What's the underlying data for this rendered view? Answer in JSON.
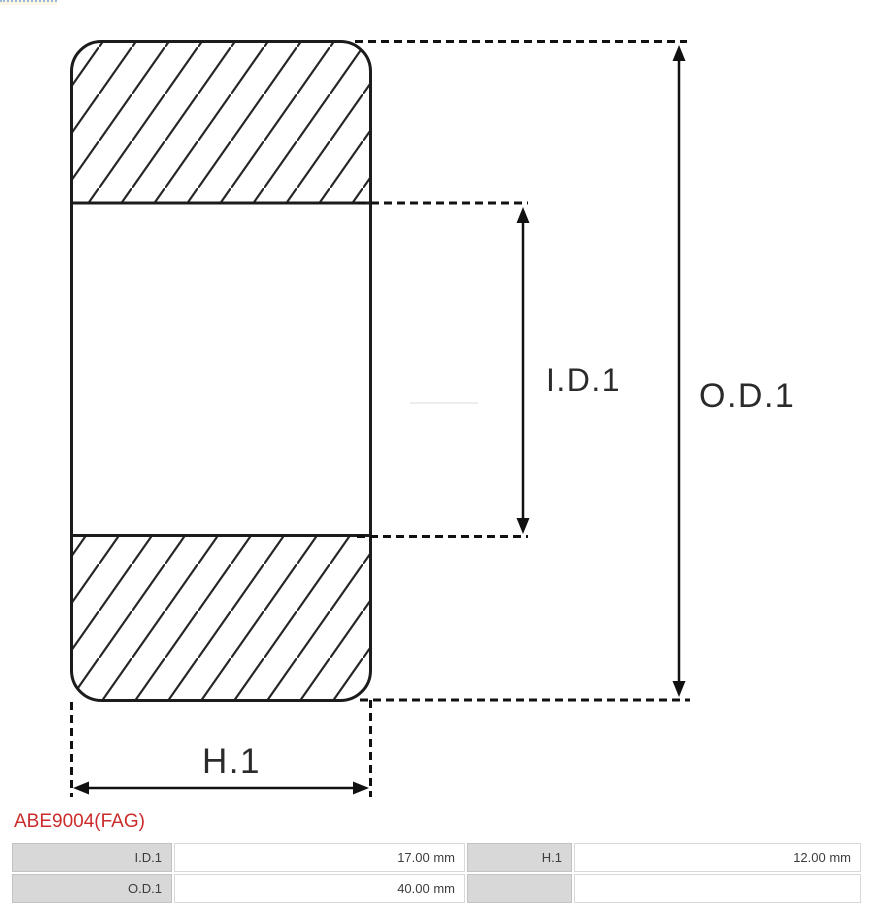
{
  "diagram": {
    "labels": {
      "inner_diameter": "I.D.1",
      "outer_diameter": "O.D.1",
      "height": "H.1"
    }
  },
  "part_code": "ABE9004(FAG)",
  "colors": {
    "part_code_red": "#cb2b2b",
    "drawing_line": "#1c1c1c",
    "table_label_bg": "#d8d8d8",
    "table_label_border": "#c2c2c2",
    "table_value_border": "#d8d8d8",
    "table_text": "#3d3d3d"
  },
  "table": {
    "rows": [
      {
        "cells": [
          "I.D.1",
          "17.00 mm",
          "H.1",
          "12.00 mm"
        ]
      },
      {
        "cells": [
          "O.D.1",
          "40.00 mm",
          "",
          ""
        ]
      }
    ]
  }
}
